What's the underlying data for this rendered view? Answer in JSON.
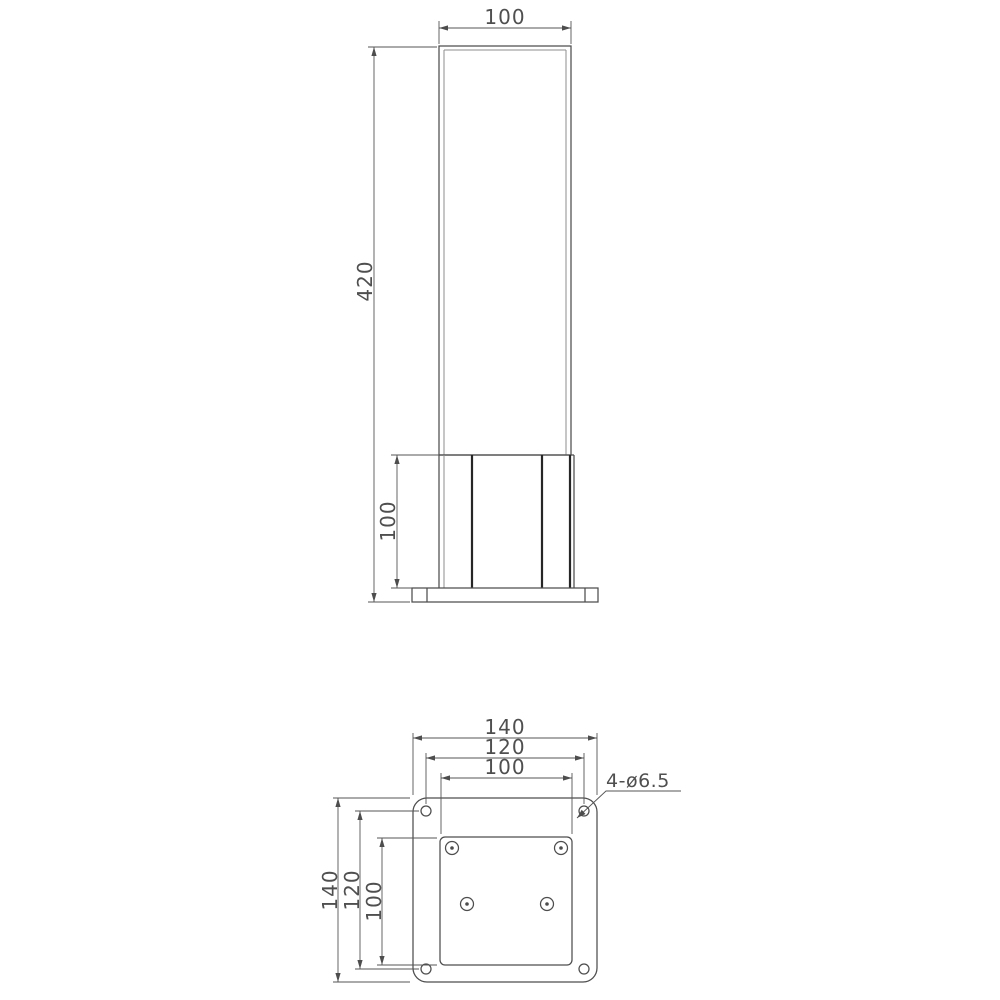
{
  "drawing": {
    "type": "technical-drawing",
    "subject": "bollard light post with square mounting plate",
    "front_view": {
      "dim_width_top": "100",
      "dim_height_total": "420",
      "dim_base_height": "100"
    },
    "plan_view": {
      "dim_width_outer": "140",
      "dim_width_holes": "120",
      "dim_width_inner": "100",
      "dim_height_outer": "140",
      "dim_height_holes": "120",
      "dim_height_inner": "100",
      "holes_label": "4-ø6.5",
      "corner_hole_count": 4,
      "screw_count": 4
    },
    "colors": {
      "line": "#4d4d4d",
      "heavy_line": "#262626",
      "background": "#ffffff"
    }
  }
}
